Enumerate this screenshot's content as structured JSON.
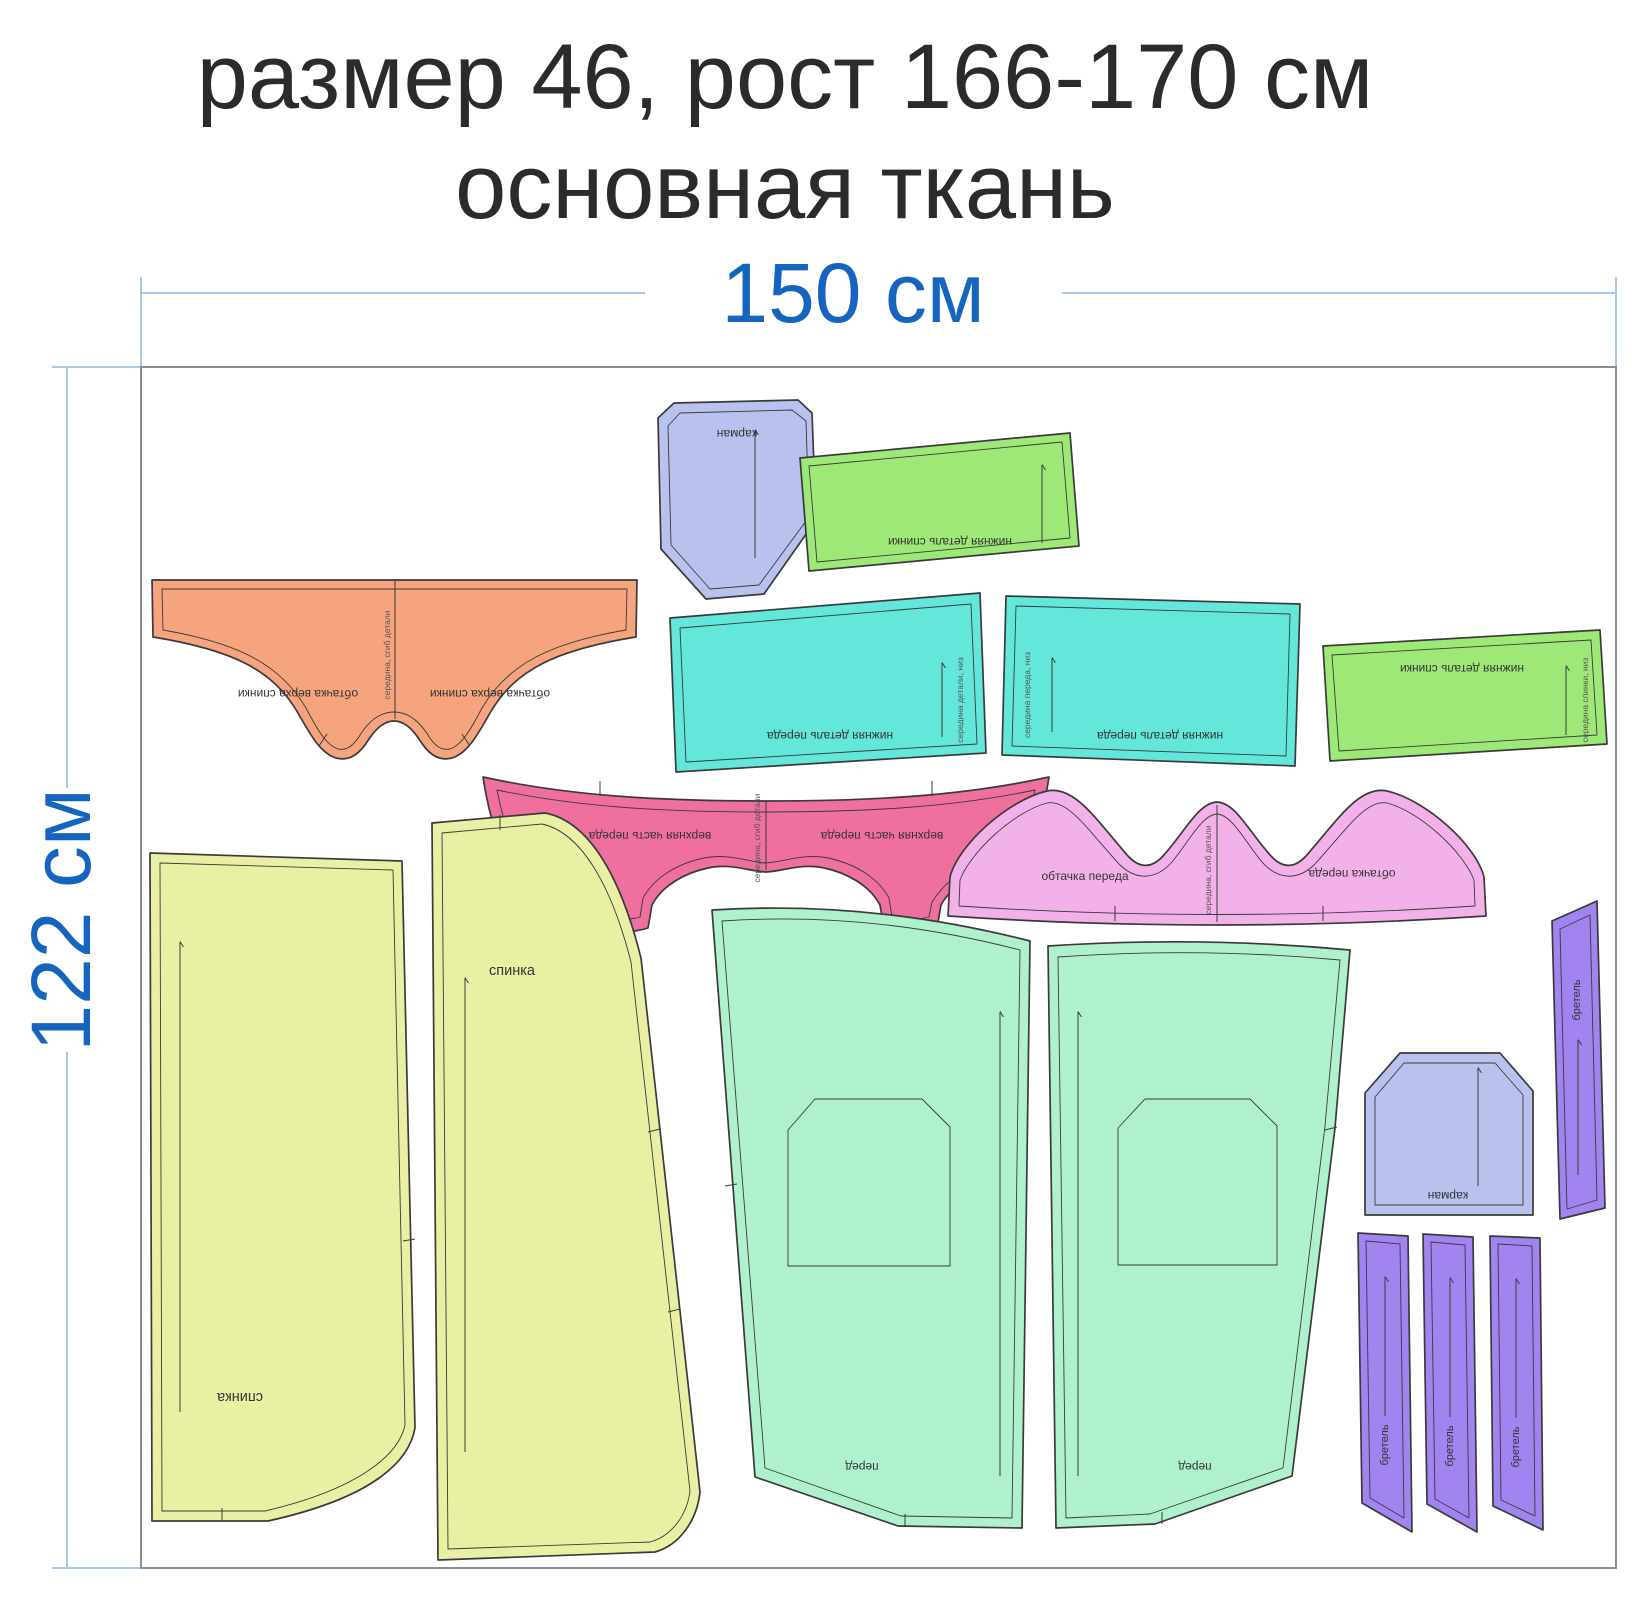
{
  "title": {
    "line1": "размер 46, рост 166-170 см",
    "line2": "основная ткань"
  },
  "dimensions": {
    "width_label": "150 см",
    "height_label": "122 см"
  },
  "labels": {
    "pocket": "карман",
    "back_lower": "нижняя деталь спинки",
    "front_lower": "нижняя деталь переда",
    "back_top_facing": "обтачка верха спинки",
    "front_upper": "верхняя часть переда",
    "front_facing": "обтачка переда",
    "back": "спинка",
    "front": "перед",
    "strap": "бретель",
    "fold_note": "середина, сгиб детали",
    "front_bottom_note": "середина переда, низ",
    "back_bottom_note": "середина спинки, низ",
    "detail_bottom_note": "середина детали, низ"
  },
  "colors": {
    "dimension_line": "#a6c9e8",
    "dimension_text": "#1565c0",
    "title_text": "#2b2b2b",
    "fabric_border": "#8d8d8d",
    "piece_outline": "#3a3a3a",
    "pocket_fill": "#b9c2ee",
    "green_fill": "#9ee878",
    "orange_fill": "#f5a47e",
    "cyan_fill": "#62e7da",
    "hotpink_fill": "#ef6f9f",
    "lightpink_fill": "#f3b1e9",
    "yellow_fill": "#e9f0a4",
    "mint_fill": "#aff0cd",
    "purple_fill": "#a184ef"
  }
}
